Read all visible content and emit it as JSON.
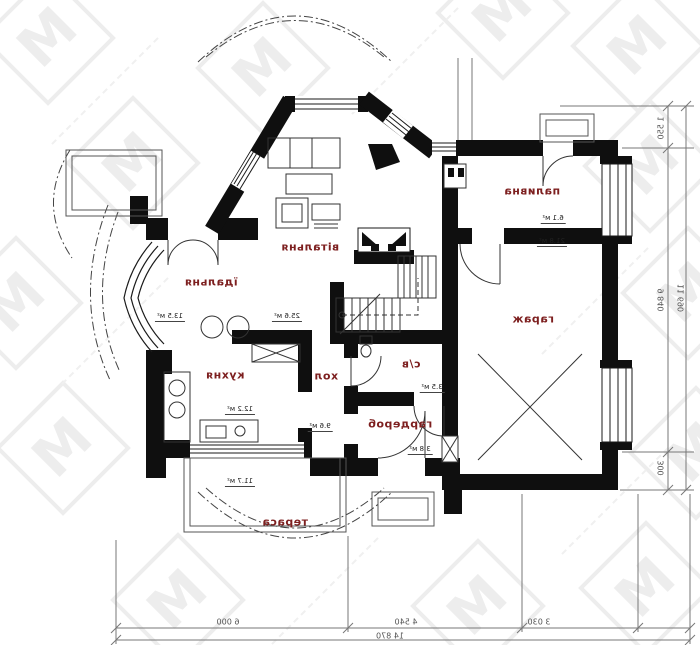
{
  "plan": {
    "rooms": [
      {
        "id": "vitalnia",
        "name": "вітальня",
        "area": "25.6 м²"
      },
      {
        "id": "idalnia",
        "name": "їдальня",
        "area": "13.5 м²"
      },
      {
        "id": "kukhnia",
        "name": "кухня",
        "area": "12.2 м²"
      },
      {
        "id": "khol",
        "name": "хол",
        "area": "9.6 м²"
      },
      {
        "id": "sv",
        "name": "с/в",
        "area": "3.5 м²"
      },
      {
        "id": "harderob",
        "name": "гардероб",
        "area": "3.8 м²"
      },
      {
        "id": "palyvna",
        "name": "паливна",
        "area": "6.1 м²"
      },
      {
        "id": "harazh",
        "name": "гараж",
        "area": "21.8 м²"
      },
      {
        "id": "terasa",
        "name": "тераса",
        "area": "11.7 м²"
      }
    ],
    "dimensions": {
      "bottom_segments": [
        "6 000",
        "4 540",
        "3 030"
      ],
      "bottom_total": "14 870",
      "right_segments": [
        "1 550",
        "9 840",
        "300"
      ],
      "right_total": "11 690"
    },
    "watermark_letter": "М",
    "colors": {
      "wall": "#0f0f0f",
      "room_label": "#7d1f1f",
      "dimension": "#555555",
      "watermark": "#ededed"
    }
  }
}
